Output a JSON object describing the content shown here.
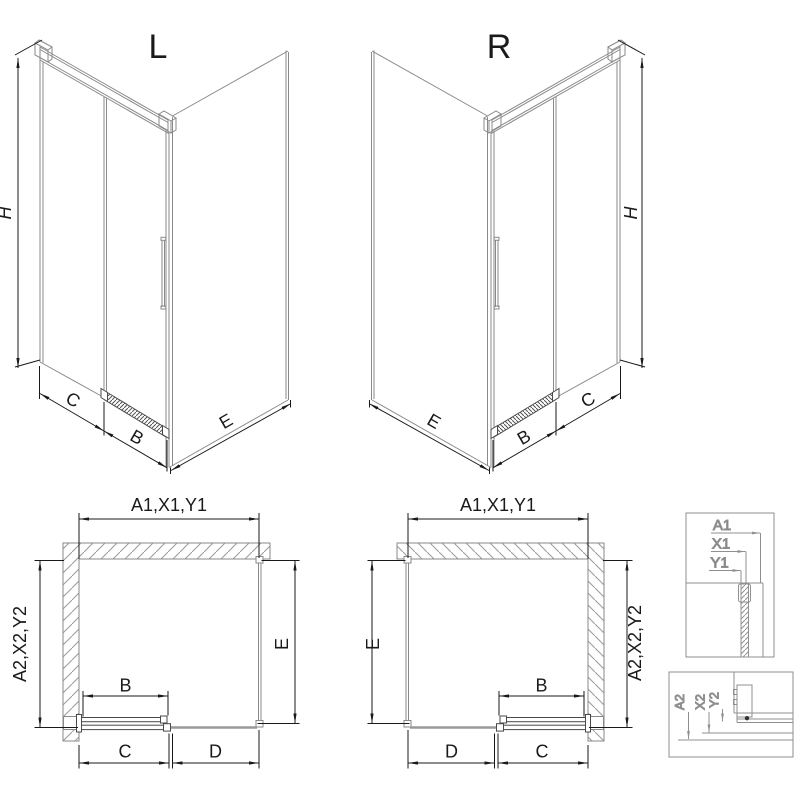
{
  "drawing": {
    "type": "shower-enclosure-technical-drawing",
    "views": {
      "iso_left": {
        "title": "L",
        "dim_height": "H",
        "dim_c": "C",
        "dim_b": "B",
        "dim_e": "E"
      },
      "iso_right": {
        "title": "R",
        "dim_height": "H",
        "dim_c": "C",
        "dim_b": "B",
        "dim_e": "E"
      },
      "plan_left": {
        "dim_top": "A1,X1,Y1",
        "dim_left": "A2,X2,Y2",
        "dim_right": "E",
        "dim_b": "B",
        "dim_c": "C",
        "dim_d": "D"
      },
      "plan_right": {
        "dim_top": "A1,X1,Y1",
        "dim_left": "E",
        "dim_right": "A2,X2,Y2",
        "dim_b": "B",
        "dim_c": "C",
        "dim_d": "D"
      },
      "detail_top": {
        "labels": [
          "A1",
          "X1",
          "Y1"
        ]
      },
      "detail_bottom": {
        "labels": [
          "A2",
          "X2",
          "Y2"
        ]
      }
    },
    "colors": {
      "background": "#ffffff",
      "drawing_line": "#8a8a8a",
      "dark_profile": "#4a4a4a",
      "dimension": "#1a1a1a",
      "hatch": "#9a9a9a",
      "glass": "#9a9a9a",
      "detail_line": "#8f8f8f"
    }
  }
}
